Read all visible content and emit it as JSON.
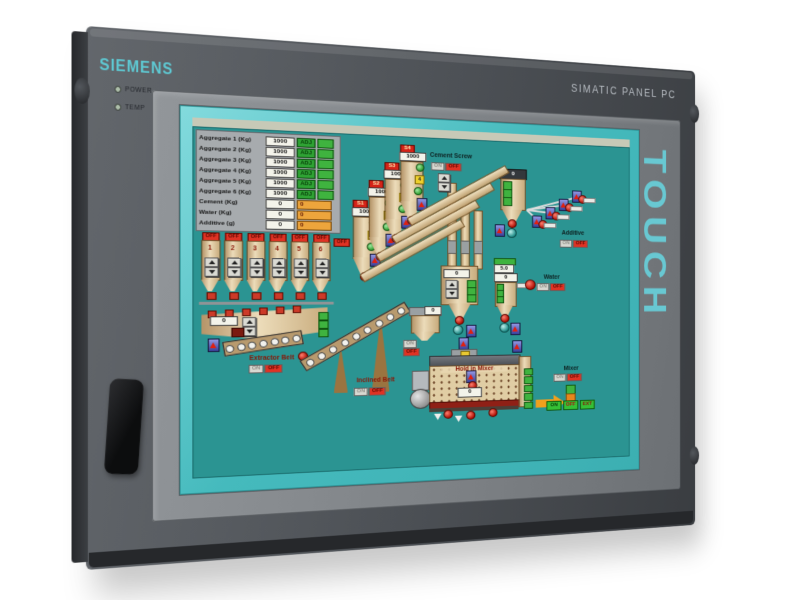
{
  "device": {
    "brand": "SIEMENS",
    "model": "SIMATIC PANEL PC",
    "touch": "TOUCH",
    "led_power": "POWER",
    "led_temp": "TEMP"
  },
  "hmi": {
    "table": {
      "rows": [
        {
          "label": "Aggregate 1 (Kg)",
          "value": "1000",
          "btn": "ADJ"
        },
        {
          "label": "Aggregate 2 (Kg)",
          "value": "1000",
          "btn": "ADJ"
        },
        {
          "label": "Aggregate 3 (Kg)",
          "value": "1000",
          "btn": "ADJ"
        },
        {
          "label": "Aggregate 4 (Kg)",
          "value": "1000",
          "btn": "ADJ"
        },
        {
          "label": "Aggregate 5 (Kg)",
          "value": "1000",
          "btn": "ADJ"
        },
        {
          "label": "Aggregate 6 (Kg)",
          "value": "1000",
          "btn": "ADJ"
        },
        {
          "label": "Cement (Kg)",
          "value": "0",
          "actual": "0"
        },
        {
          "label": "Water (Kg)",
          "value": "0",
          "actual": "0"
        },
        {
          "label": "Additive (g)",
          "value": "0",
          "actual": "0"
        }
      ]
    },
    "bins": {
      "off": "OFF",
      "numbers": [
        "1",
        "2",
        "3",
        "4",
        "5",
        "6"
      ]
    },
    "silos": [
      {
        "tag": "S1",
        "value": "1000",
        "num": "1"
      },
      {
        "tag": "S2",
        "value": "1000",
        "num": "2"
      },
      {
        "tag": "S3",
        "value": "1000",
        "num": "3"
      },
      {
        "tag": "S4",
        "value": "1000",
        "num": "4"
      }
    ],
    "cement_screw": {
      "label": "Cement Screw",
      "on": "ON",
      "off": "OFF"
    },
    "cement_hopper": {
      "value": "0"
    },
    "additive": {
      "label": "Additive",
      "on": "ON",
      "off": "OFF"
    },
    "agg_hopper": {
      "value": "0"
    },
    "water": {
      "label": "Water",
      "on": "ON",
      "off": "OFF",
      "set": "5.0",
      "value": "0"
    },
    "extractor": {
      "label": "Extractor Belt",
      "on": "ON",
      "off": "OFF",
      "value": "0"
    },
    "inclined": {
      "label": "Inclined Belt",
      "on": "ON",
      "off": "OFF"
    },
    "feed_hopper": {
      "value": "0",
      "on": "ON",
      "off": "OFF"
    },
    "mixer": {
      "label": "Mixer",
      "on": "ON",
      "off": "OFF",
      "status": "Hold in Mixer",
      "value": "0",
      "cmd_on": "ON",
      "cmd_off": "OFF",
      "cmd_ext": "EXT"
    }
  }
}
